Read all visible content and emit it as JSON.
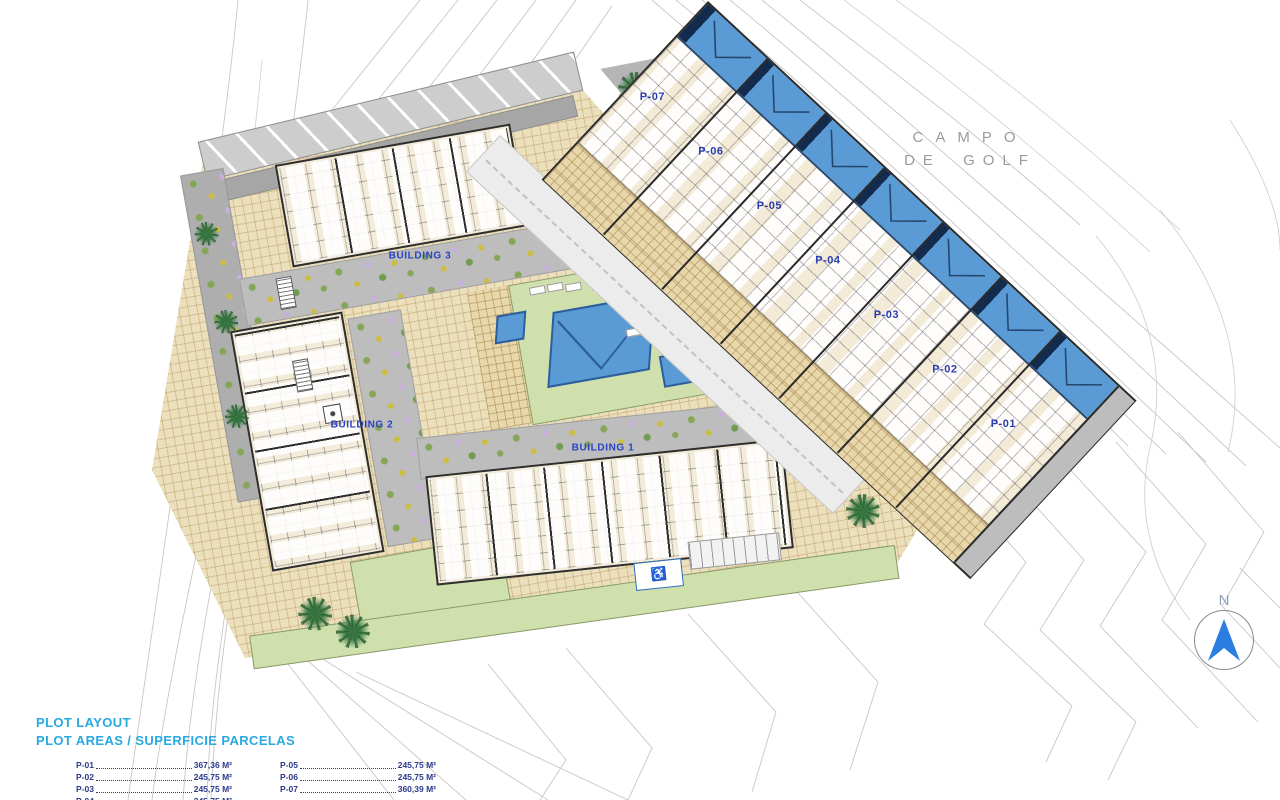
{
  "golf": {
    "line1": "CAMPO",
    "line2": "DE GOLF"
  },
  "plan": {
    "buildings": [
      {
        "label": "BUILDING 1"
      },
      {
        "label": "BUILDING 2"
      },
      {
        "label": "BUILDING 3"
      }
    ],
    "plots": [
      {
        "label": "P-07"
      },
      {
        "label": "P-06"
      },
      {
        "label": "P-05"
      },
      {
        "label": "P-04"
      },
      {
        "label": "P-03"
      },
      {
        "label": "P-02"
      },
      {
        "label": "P-01"
      }
    ]
  },
  "compass": {
    "north_label": "N"
  },
  "accessibility": {
    "disabled_parking_symbol": "♿"
  },
  "legend": {
    "title": "PLOT LAYOUT",
    "subtitle": "PLOT AREAS / SUPERFICIE PARCELAS",
    "columns": [
      {
        "items": [
          {
            "id": "P-01",
            "area": "367,36 M²"
          },
          {
            "id": "P-02",
            "area": "245,75 M²"
          },
          {
            "id": "P-03",
            "area": "245,75 M²"
          },
          {
            "id": "P-04",
            "area": "245,75 M²"
          }
        ]
      },
      {
        "items": [
          {
            "id": "P-05",
            "area": "245,75 M²"
          },
          {
            "id": "P-06",
            "area": "245,75 M²"
          },
          {
            "id": "P-07",
            "area": "360,39 M²"
          }
        ]
      }
    ]
  },
  "colors": {
    "pool_blue": "#5b9bd5",
    "pool_dark": "#132c4e",
    "paving_tan": "#ecdfbc",
    "lawn_green": "#cfe0ad",
    "road_grey": "#bdbdbd",
    "plot_label_blue": "#2b3db0",
    "legend_title_blue": "#29a9e1",
    "legend_text_navy": "#2b3a8c",
    "compass_arrow_blue": "#2b7de1"
  }
}
